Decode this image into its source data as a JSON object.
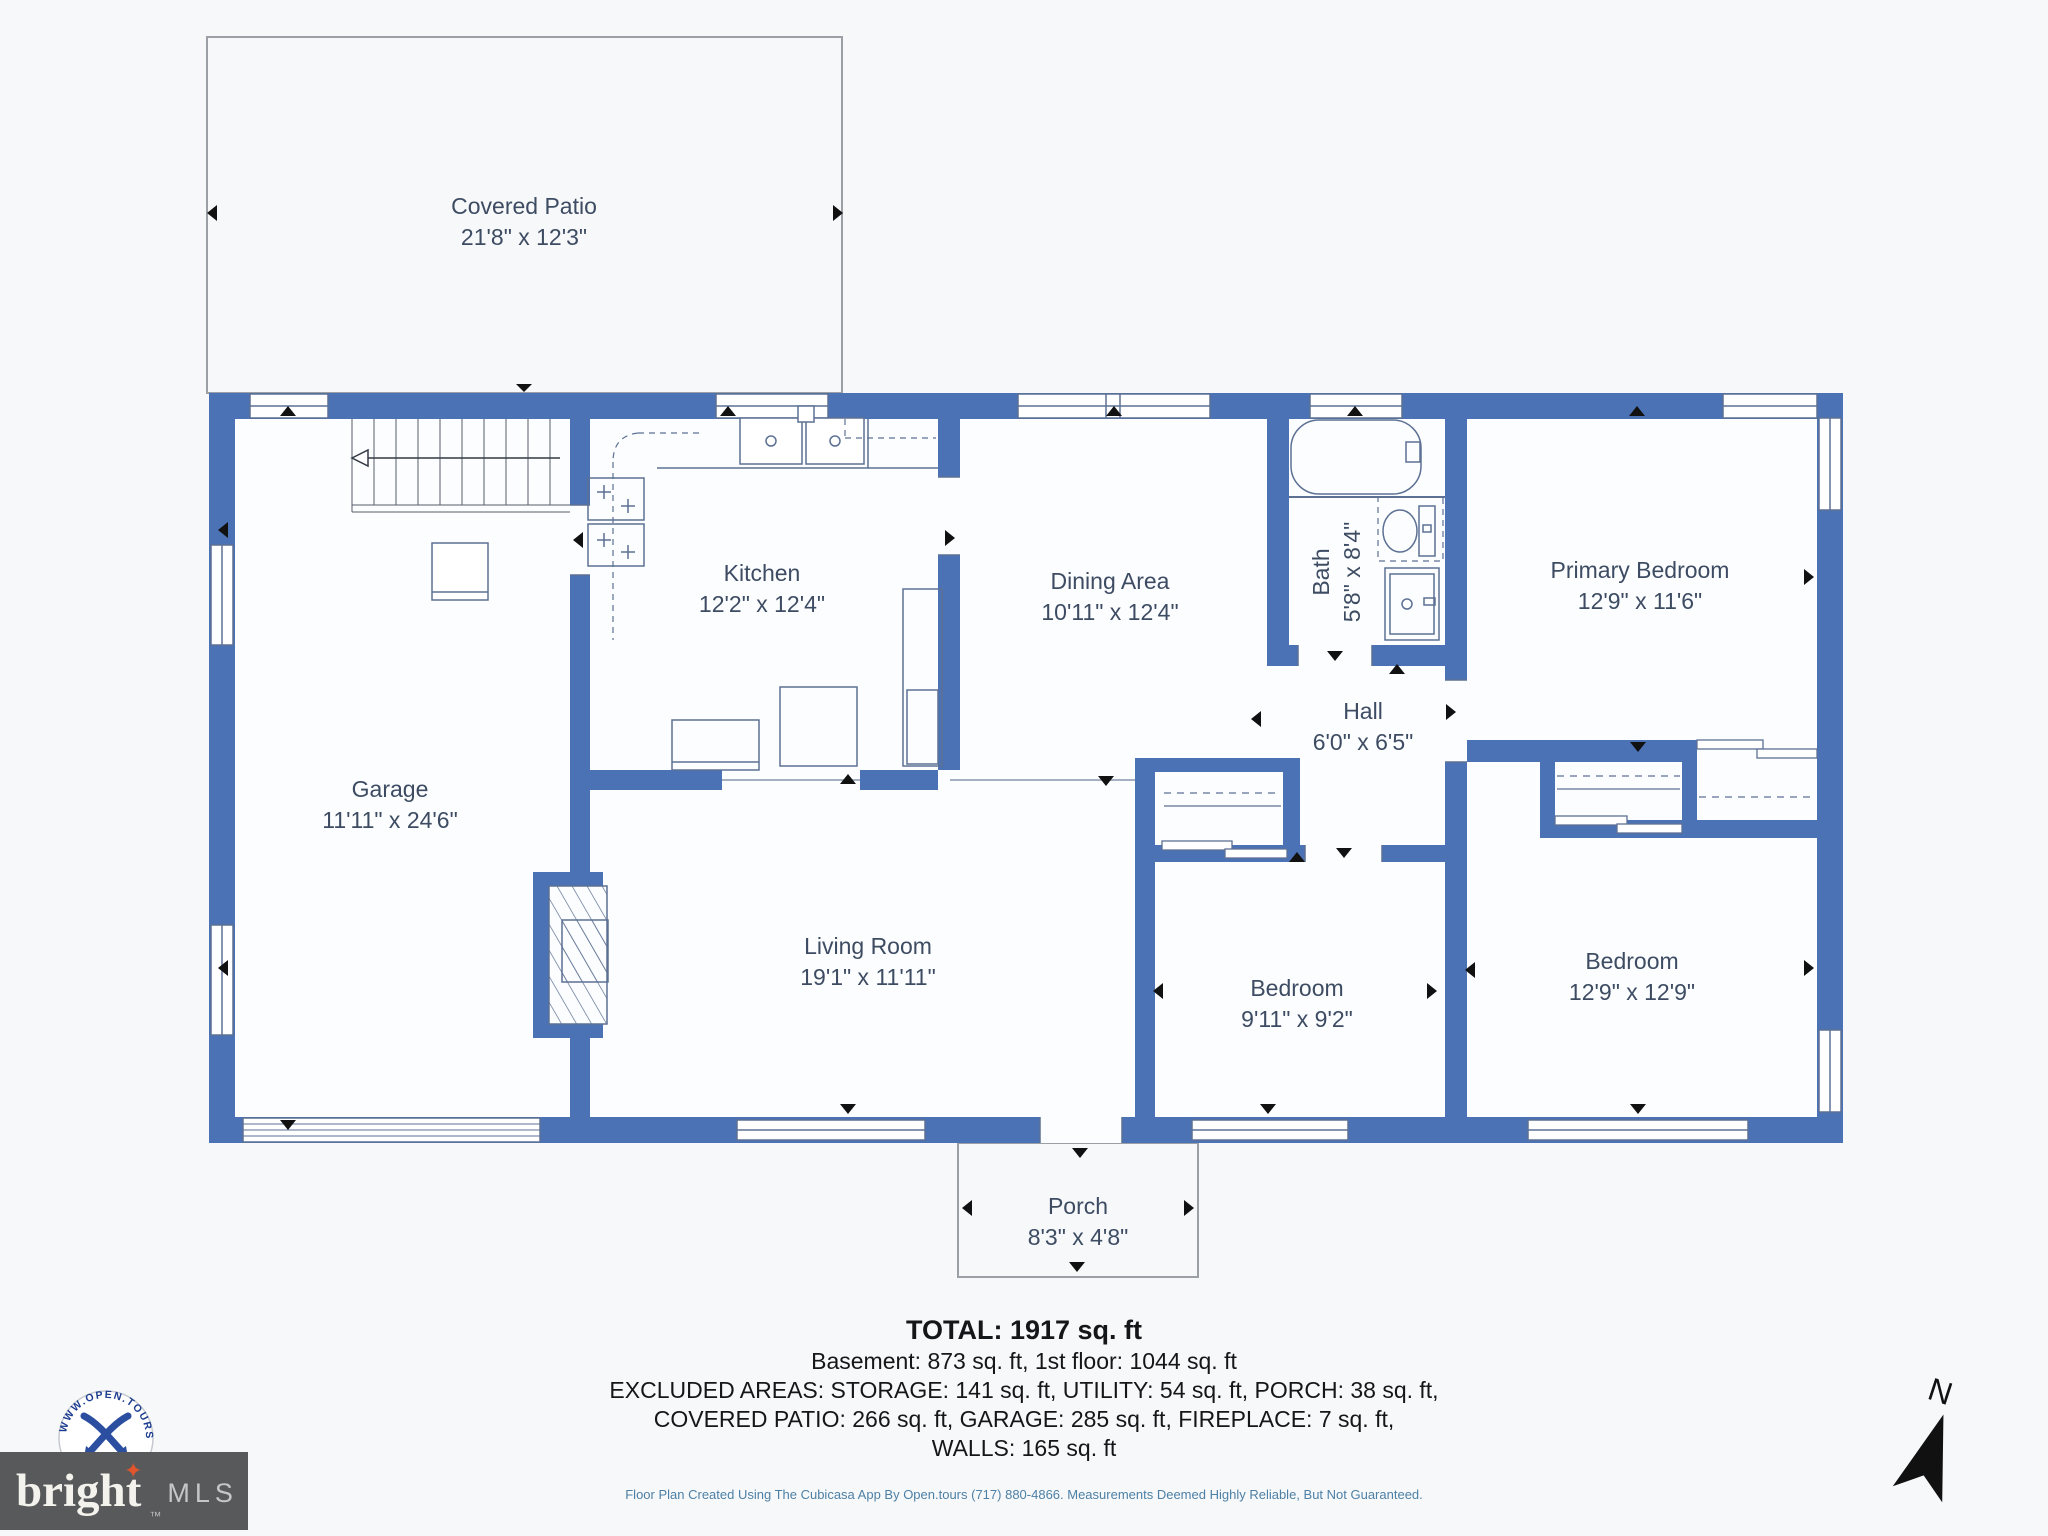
{
  "colors": {
    "wall": "#4c72b6",
    "fixture": "#5d7194",
    "outline": "#9aa0a6",
    "label_text": "#3d4c63",
    "footer_text": "#14171a",
    "disclaimer_text": "#4d80a6",
    "logo_box": "#58595b",
    "logo_star": "#e0552c",
    "badge_blue": "#2b4ea0"
  },
  "rooms": [
    {
      "id": "covered-patio",
      "name": "Covered Patio",
      "dims": "21'8\" x 12'3\""
    },
    {
      "id": "kitchen",
      "name": "Kitchen",
      "dims": "12'2\" x 12'4\""
    },
    {
      "id": "dining-area",
      "name": "Dining Area",
      "dims": "10'11\" x 12'4\""
    },
    {
      "id": "bath",
      "name": "Bath",
      "dims": "5'8\" x 8'4\""
    },
    {
      "id": "primary-bedroom",
      "name": "Primary Bedroom",
      "dims": "12'9\" x 11'6\""
    },
    {
      "id": "garage",
      "name": "Garage",
      "dims": "11'11\" x 24'6\""
    },
    {
      "id": "hall",
      "name": "Hall",
      "dims": "6'0\" x 6'5\""
    },
    {
      "id": "living-room",
      "name": "Living Room",
      "dims": "19'1\" x 11'11\""
    },
    {
      "id": "bedroom-middle",
      "name": "Bedroom",
      "dims": "9'11\" x 9'2\""
    },
    {
      "id": "bedroom-right",
      "name": "Bedroom",
      "dims": "12'9\" x 12'9\""
    },
    {
      "id": "porch",
      "name": "Porch",
      "dims": "8'3\" x 4'8\""
    }
  ],
  "summary": {
    "total": "TOTAL: 1917 sq. ft",
    "line1": "Basement: 873 sq. ft, 1st floor: 1044 sq. ft",
    "line2": "EXCLUDED AREAS: STORAGE: 141 sq. ft, UTILITY: 54 sq. ft, PORCH: 38 sq. ft,",
    "line3": "COVERED PATIO: 266 sq. ft, GARAGE: 285 sq. ft, FIREPLACE: 7 sq. ft,",
    "line4": "WALLS: 165 sq. ft"
  },
  "disclaimer": "Floor Plan Created Using The Cubicasa App By Open.tours (717) 880-4866. Measurements Deemed Highly Reliable, But Not Guaranteed.",
  "compass": {
    "label": "N"
  },
  "logos": {
    "bright": {
      "text": "bright",
      "tm": "™",
      "suffix": "MLS",
      "star_icon": "✦"
    },
    "badge": {
      "arc_text": "WWW.OPEN.TOURS"
    }
  }
}
